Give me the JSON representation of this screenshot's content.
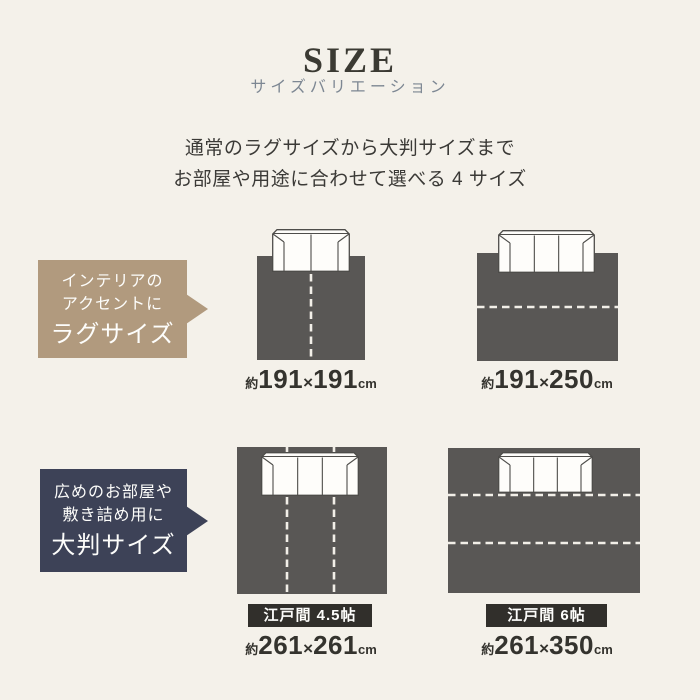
{
  "header": {
    "title": "SIZE",
    "subtitle": "サイズバリエーション"
  },
  "intro": {
    "line1": "通常のラグサイズから大判サイズまで",
    "line2": "お部屋や用途に合わせて選べる 4 サイズ"
  },
  "sections": {
    "rug": {
      "callout": {
        "line1": "インテリアの",
        "line2": "アクセントに",
        "title": "ラグサイズ"
      },
      "items": [
        {
          "approx": "約",
          "width": "191",
          "times": "×",
          "depth": "191",
          "unit": "cm"
        },
        {
          "approx": "約",
          "width": "191",
          "times": "×",
          "depth": "250",
          "unit": "cm"
        }
      ]
    },
    "large": {
      "callout": {
        "line1": "広めのお部屋や",
        "line2": "敷き詰め用に",
        "title": "大判サイズ"
      },
      "items": [
        {
          "tag": "江戸間 4.5帖",
          "approx": "約",
          "width": "261",
          "times": "×",
          "depth": "261",
          "unit": "cm"
        },
        {
          "tag": "江戸間 6帖",
          "approx": "約",
          "width": "261",
          "times": "×",
          "depth": "350",
          "unit": "cm"
        }
      ]
    }
  },
  "colors": {
    "background": "#f4f1ea",
    "title_text": "#3b3a33",
    "subtitle_text": "#7d8793",
    "body_text": "#3b3a37",
    "callout_rug": "#b19a7e",
    "callout_large": "#3d4257",
    "rug_fill": "#595755",
    "fold_line": "#f2efe8",
    "tag_background": "#312f2b",
    "caption_text": "#34332e"
  }
}
